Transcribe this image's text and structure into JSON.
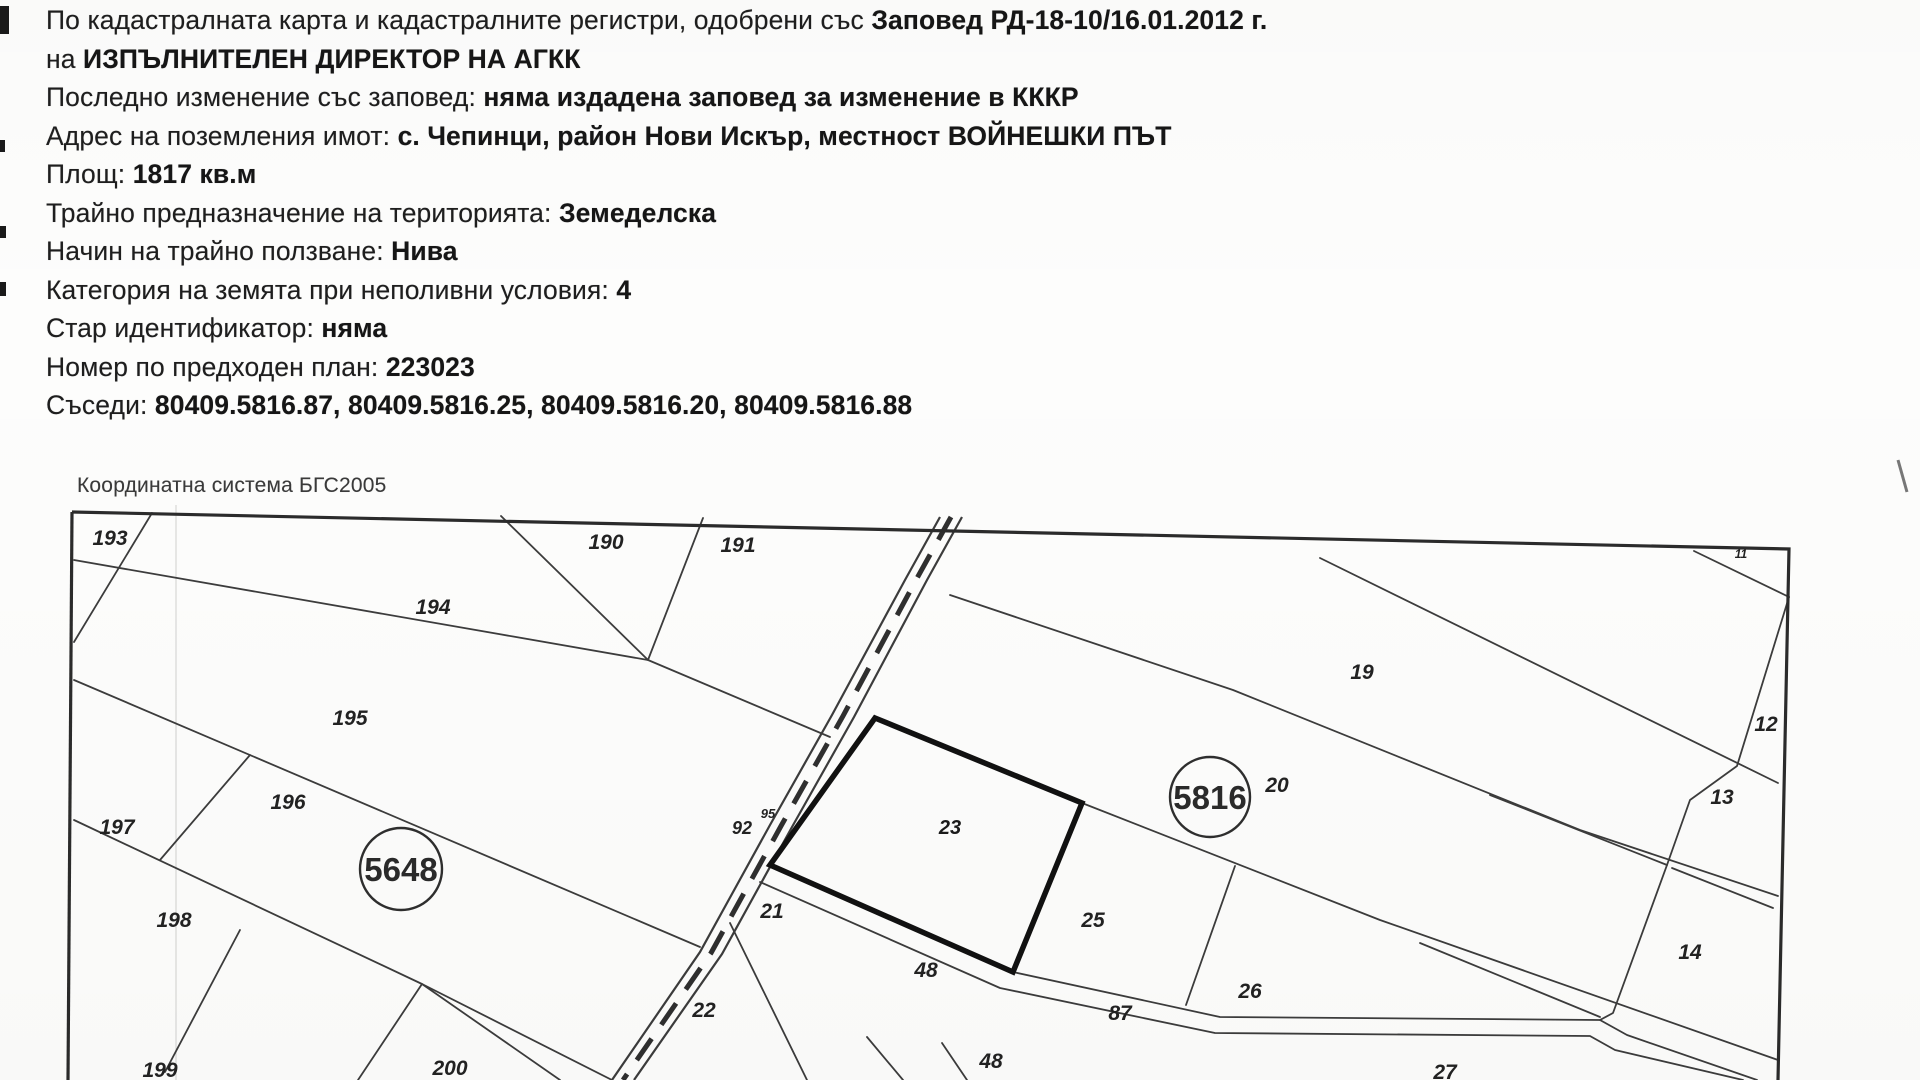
{
  "document": {
    "header_lines": [
      {
        "prefix": "По кадастралната карта и кадастралните регистри, одобрени със ",
        "value": "Заповед РД-18-10/16.01.2012 г."
      },
      {
        "prefix": "на ",
        "value": "ИЗПЪЛНИТЕЛЕН ДИРЕКТОР НА АГКК"
      },
      {
        "prefix": "Последно изменение със заповед: ",
        "value": "няма издадена заповед за изменение в КККР"
      },
      {
        "prefix": "Адрес на поземления имот: ",
        "value": "с. Чепинци, район Нови Искър, местност ВОЙНЕШКИ ПЪТ"
      },
      {
        "prefix": "Площ: ",
        "value": "1817 кв.м"
      },
      {
        "prefix": "Трайно предназначение на територията: ",
        "value": "Земеделска"
      },
      {
        "prefix": "Начин на трайно ползване: ",
        "value": "Нива"
      },
      {
        "prefix": "Категория на земята при неполивни условия: ",
        "value": "4"
      },
      {
        "prefix": "Стар идентификатор: ",
        "value": "няма"
      },
      {
        "prefix": "Номер по предходен план: ",
        "value": "223023"
      },
      {
        "prefix": "Съседи: ",
        "value": "80409.5816.87, 80409.5816.25, 80409.5816.20, 80409.5816.88"
      }
    ],
    "coordinate_system": "Координатна система БГС2005"
  },
  "map": {
    "ink_color": "#3c3c3c",
    "bold_color": "#111111",
    "border_polylines": [
      "72,512 1789,549 1778,1080",
      "72,512 68,1080"
    ],
    "boundary_lines": [
      "152,513 74,642",
      "501,516 648,660",
      "703,518 648,660",
      "74,560 648,660 830,737",
      "74,680 700,947",
      "74,820 422,984 560,1080",
      "422,984 358,1080",
      "250,755 160,860",
      "240,930 165,1072",
      "422,984 612,1080",
      "950,595 1233,690 1580,830 1778,896",
      "1082,803 1380,920 1778,1060",
      "1235,866 1186,1005",
      "1013,972 1220,1017 1600,1020 1627,1035 1757,1080",
      "760,882 1000,988 1215,1033 1590,1036 1615,1050 1743,1080",
      "730,923 807,1080",
      "867,1037 903,1080",
      "942,1043 967,1080",
      "1694,551 1789,597",
      "1320,558 1778,783",
      "1789,597 1737,766 1690,800 1667,865 1613,1013 1600,1020",
      "1490,795 1667,865",
      "1420,943 1600,1017",
      "1672,868 1773,908"
    ],
    "road": {
      "left": "940,517 905,580 832,715 770,825 700,952 612,1080",
      "right": "962,517 927,580 854,717 792,827 722,954 634,1080",
      "center": "951,517 916,580 843,716 781,826 711,953 623,1080"
    },
    "focus_parcel": {
      "label": "23",
      "polygon": "875,718 1082,803 1013,972 770,865",
      "label_x": 950,
      "label_y": 834
    },
    "region_circles": [
      {
        "label": "5648",
        "x": 401,
        "y": 869,
        "r": 41
      },
      {
        "label": "5816",
        "x": 1210,
        "y": 797,
        "r": 40
      }
    ],
    "parcel_labels": [
      {
        "text": "193",
        "x": 110,
        "y": 545
      },
      {
        "text": "194",
        "x": 433,
        "y": 614
      },
      {
        "text": "190",
        "x": 606,
        "y": 549
      },
      {
        "text": "191",
        "x": 738,
        "y": 552
      },
      {
        "text": "19",
        "x": 1362,
        "y": 679
      },
      {
        "text": "11",
        "x": 1741,
        "y": 558,
        "size": 12
      },
      {
        "text": "12",
        "x": 1766,
        "y": 731
      },
      {
        "text": "13",
        "x": 1722,
        "y": 804
      },
      {
        "text": "195",
        "x": 350,
        "y": 725
      },
      {
        "text": "196",
        "x": 288,
        "y": 809
      },
      {
        "text": "197",
        "x": 117,
        "y": 834
      },
      {
        "text": "198",
        "x": 174,
        "y": 927
      },
      {
        "text": "199",
        "x": 160,
        "y": 1077
      },
      {
        "text": "200",
        "x": 450,
        "y": 1075
      },
      {
        "text": "22",
        "x": 704,
        "y": 1017
      },
      {
        "text": "21",
        "x": 772,
        "y": 918
      },
      {
        "text": "92",
        "x": 742,
        "y": 834,
        "size": 18
      },
      {
        "text": "95",
        "x": 768,
        "y": 818,
        "size": 13
      },
      {
        "text": "25",
        "x": 1093,
        "y": 927
      },
      {
        "text": "48",
        "x": 926,
        "y": 977
      },
      {
        "text": "87",
        "x": 1120,
        "y": 1020
      },
      {
        "text": "48",
        "x": 991,
        "y": 1068
      },
      {
        "text": "26",
        "x": 1250,
        "y": 998
      },
      {
        "text": "20",
        "x": 1277,
        "y": 792
      },
      {
        "text": "14",
        "x": 1690,
        "y": 959
      },
      {
        "text": "27",
        "x": 1445,
        "y": 1079
      }
    ]
  }
}
